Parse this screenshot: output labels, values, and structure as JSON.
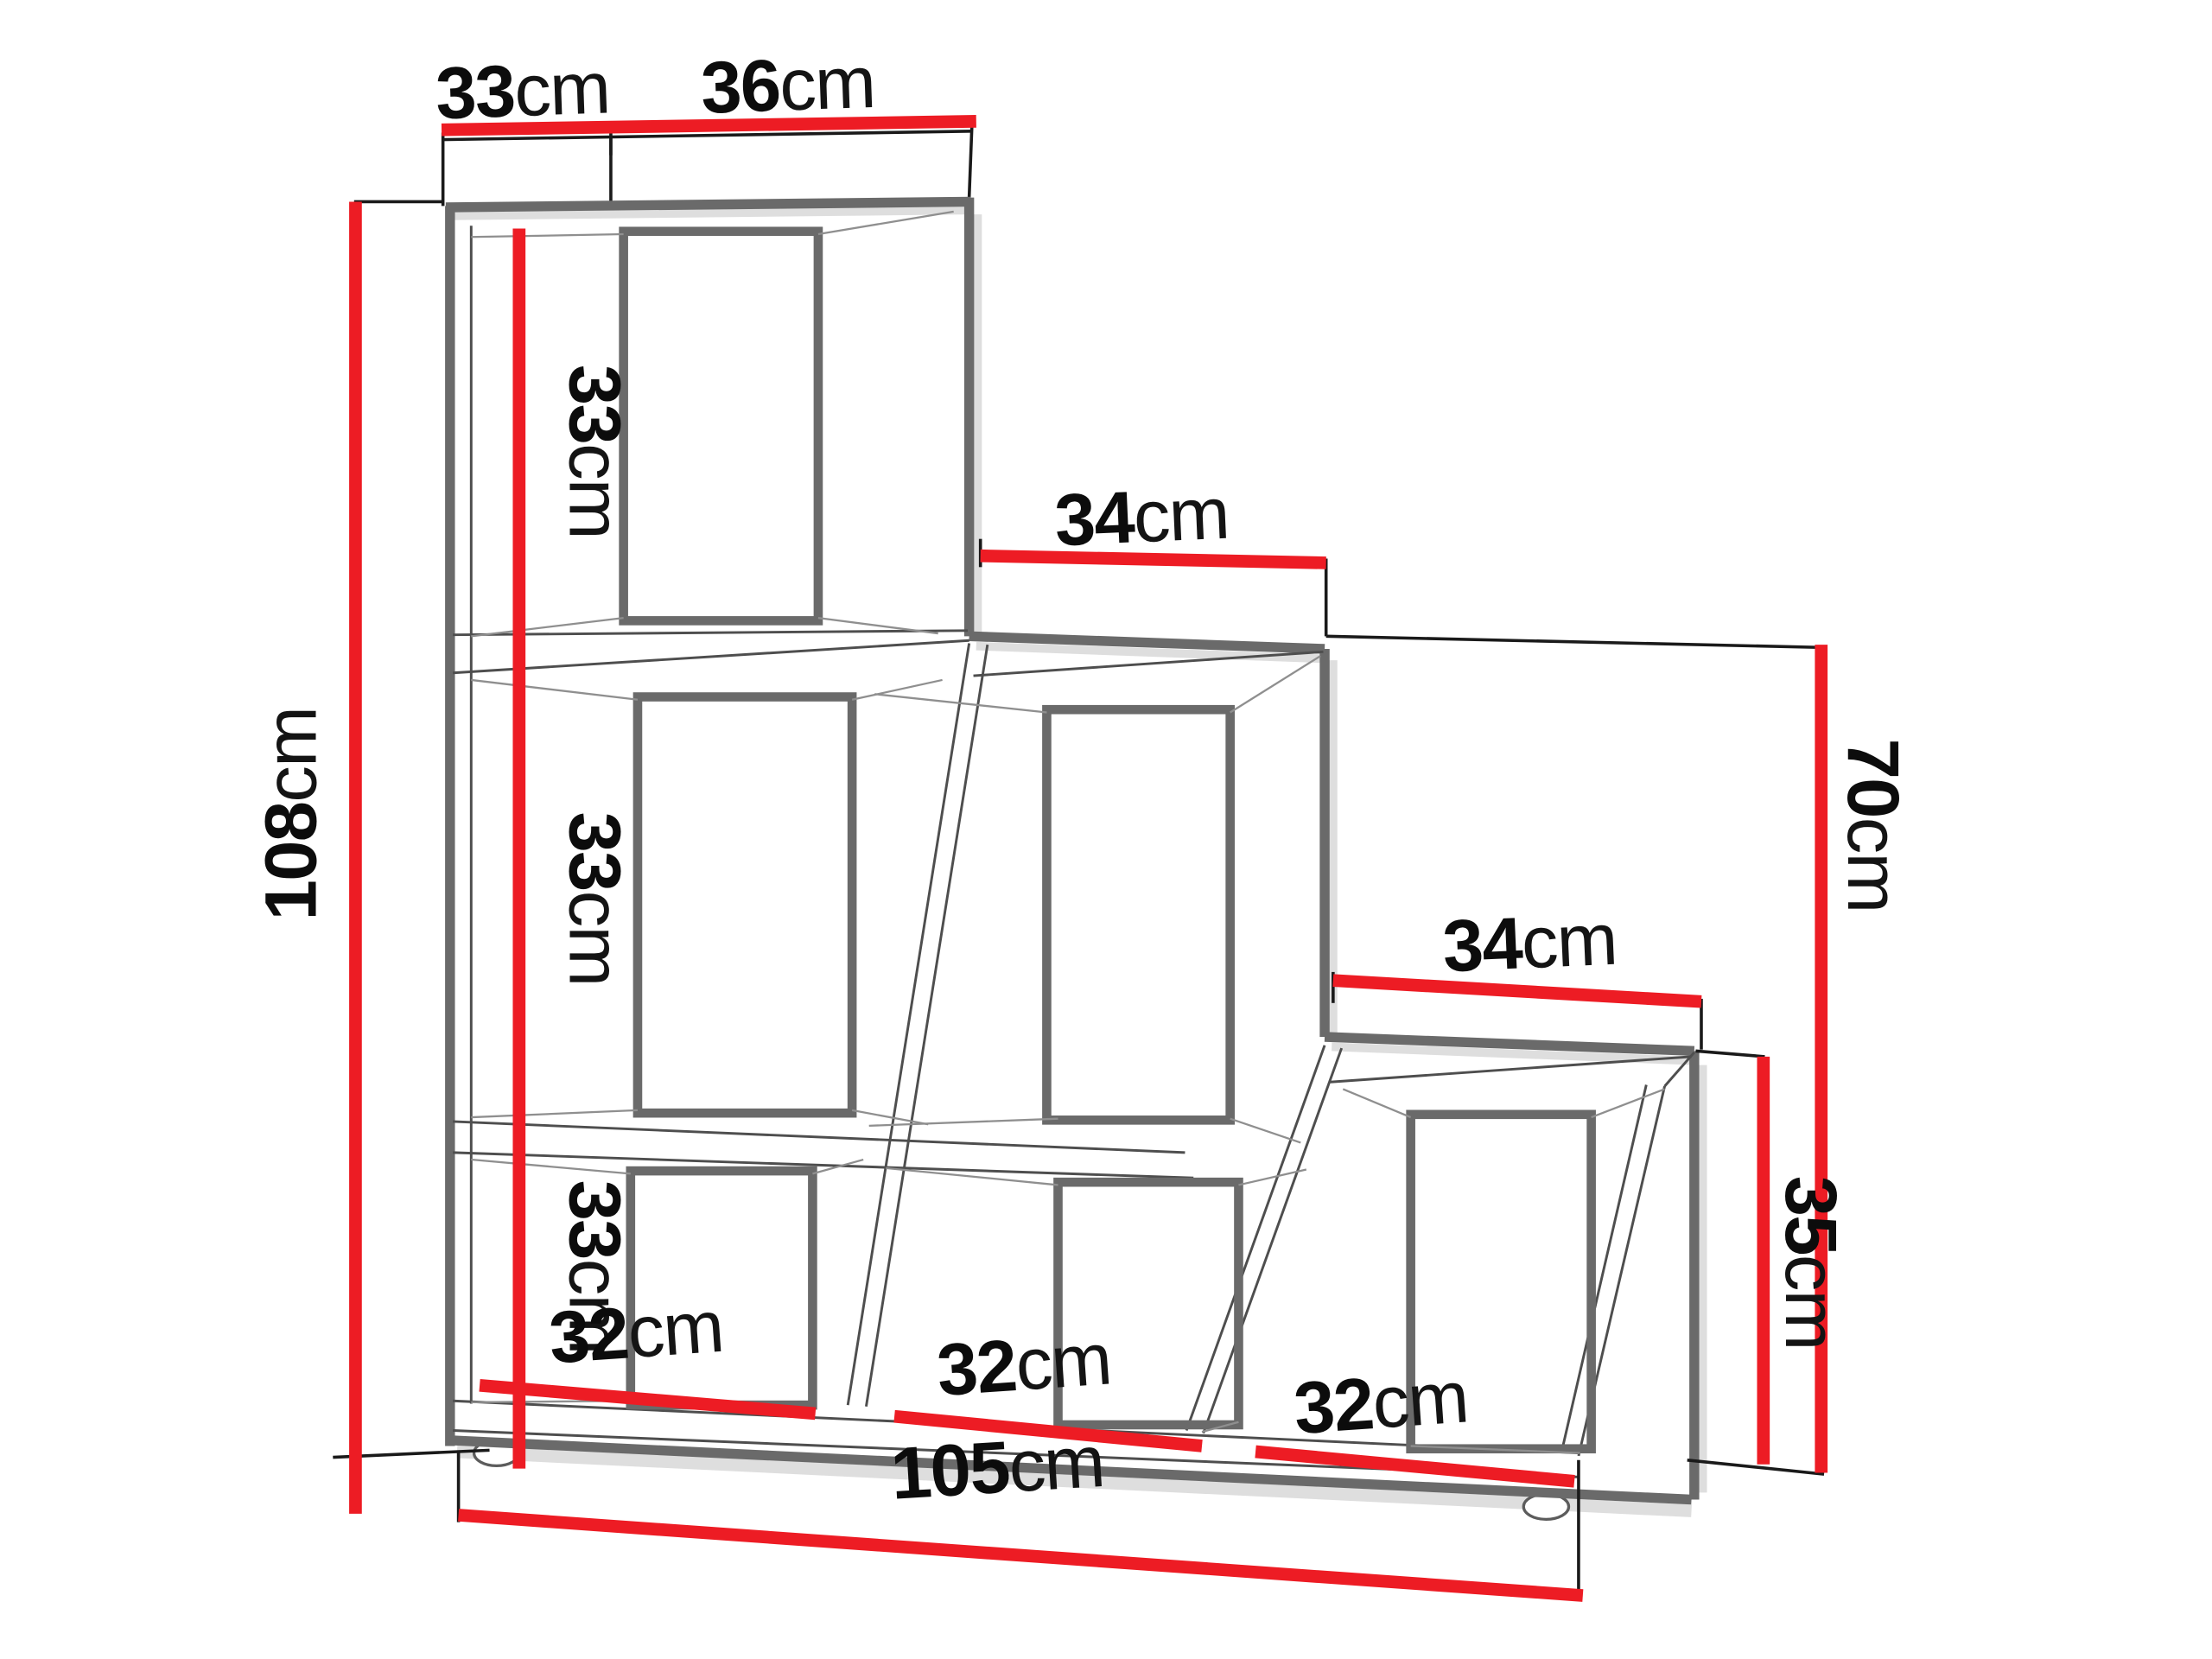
{
  "diagram": {
    "kind": "furniture-dimension-diagram",
    "subject": "three-step staircase shelf / step bookcase with six cubbies",
    "colors": {
      "dimension_line": "#ed1c24",
      "structure_outline": "#6a6a6a",
      "text": "#0c0c0c",
      "background": "#ffffff"
    },
    "dimensions": {
      "top_depth": {
        "value": "33",
        "unit": "cm"
      },
      "top_width": {
        "value": "36",
        "unit": "cm"
      },
      "total_height": {
        "value": "108",
        "unit": "cm"
      },
      "shelf_heights": [
        {
          "value": "33",
          "unit": "cm"
        },
        {
          "value": "33",
          "unit": "cm"
        },
        {
          "value": "33",
          "unit": "cm"
        }
      ],
      "middle_step_width": {
        "value": "34",
        "unit": "cm"
      },
      "right_step_width": {
        "value": "34",
        "unit": "cm"
      },
      "middle_step_height": {
        "value": "70",
        "unit": "cm"
      },
      "right_step_height": {
        "value": "35",
        "unit": "cm"
      },
      "cell_widths": [
        {
          "value": "32",
          "unit": "cm"
        },
        {
          "value": "32",
          "unit": "cm"
        },
        {
          "value": "32",
          "unit": "cm"
        }
      ],
      "total_width": {
        "value": "105",
        "unit": "cm"
      }
    }
  }
}
